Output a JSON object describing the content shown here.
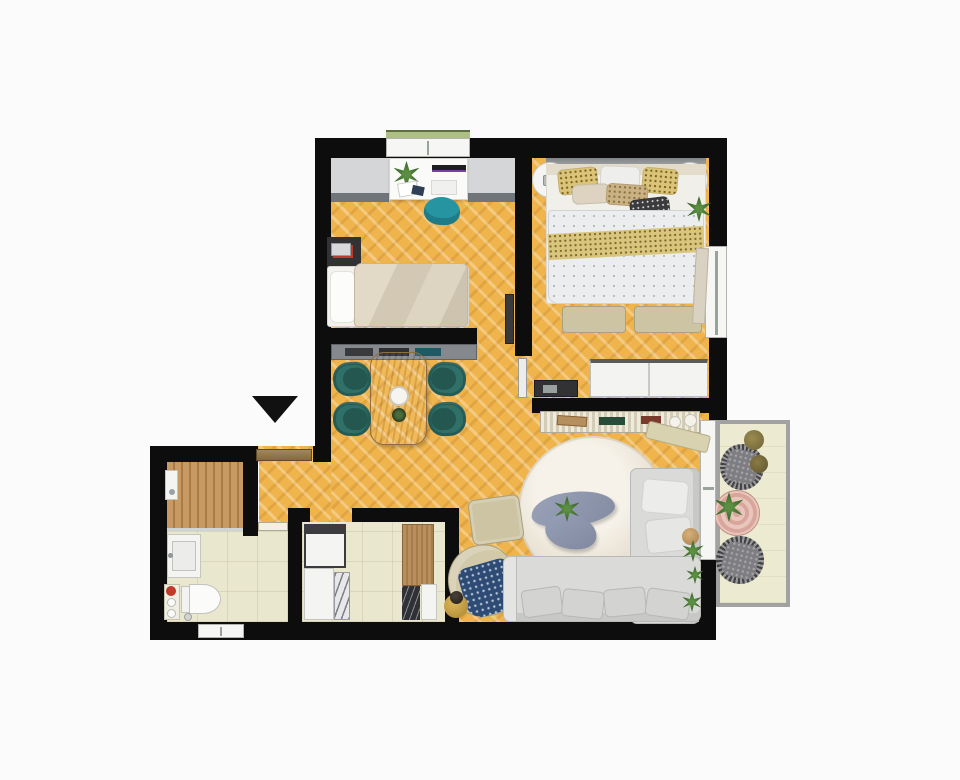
{
  "scene": {
    "kind": "apartment-floor-plan-3d-render",
    "view": "top-down",
    "canvas": {
      "width": 960,
      "height": 780
    },
    "text_visible": "none"
  },
  "colors": {
    "bg": "#fbfbfb",
    "wall": "#0d0d0d",
    "parquet": "#efb44c",
    "tile": "#e9e7cd",
    "wood-deck": "#c69a62",
    "wood-deck-dark": "#aa7b42",
    "balcony-floor": "#ecead0",
    "railing": "#a2a2a2",
    "teal-chair": "#2f7068",
    "teal-chair-dark": "#235750",
    "desk-chair-teal": "#2795a1",
    "sofa": "#dadad8",
    "beige-furniture": "#cdc4a3",
    "duvet": "#ecedee",
    "gold-band": "#d9c478",
    "wood-table": "#bb9264",
    "door-brown": "#92754a",
    "coffee-table": "#959db4",
    "throw-blue": "#2d4b74",
    "rug": "#f2ede3",
    "plant-green": "#2f5d23",
    "flower-red": "#c23a2c",
    "cushion-grey": "#7e7e82",
    "pouf-olive": "#857741",
    "counter-grey": "#d4d6d8",
    "counter-edge": "#70757a",
    "white-furniture": "#f4f4f2",
    "dark-furniture": "#323234",
    "slat-console": "#e6dfca"
  },
  "marker": {
    "entrance_arrow": {
      "shape": "triangle",
      "direction": "down",
      "color": "#111111"
    }
  },
  "rooms": [
    {
      "name": "office-bedroom",
      "floor": "parquet",
      "furniture": [
        "desk",
        "desk-cabinets",
        "desk-chair",
        "single-bed",
        "nightstand",
        "window"
      ]
    },
    {
      "name": "master-bedroom",
      "floor": "parquet",
      "furniture": [
        "double-bed",
        "round-nightstand-left",
        "round-nightstand-right",
        "foot-bench-left",
        "foot-bench-right",
        "wardrobe",
        "media-console",
        "plant",
        "window"
      ]
    },
    {
      "name": "dining-hall",
      "floor": "parquet",
      "furniture": [
        "dining-table",
        "dining-chairs-x4",
        "sideboard",
        "entry-door"
      ]
    },
    {
      "name": "living-room",
      "floor": "parquet",
      "furniture": [
        "corner-sofa",
        "round-rug",
        "coffee-table",
        "ottoman",
        "armchair",
        "side-table",
        "slat-console",
        "bench",
        "plants",
        "balcony-door"
      ]
    },
    {
      "name": "kitchen",
      "floor": "tile",
      "furniture": [
        "fridge",
        "base-cabinet",
        "marble-unit",
        "tall-wood-cabinet",
        "dark-marble-unit",
        "white-unit"
      ]
    },
    {
      "name": "bathroom",
      "floor": "tile",
      "furniture": [
        "shower-deck",
        "shower-fixture",
        "vanity-sink",
        "toilet",
        "shelf-with-flower",
        "floor-drain",
        "window"
      ]
    },
    {
      "name": "balcony",
      "floor": "tile-light",
      "furniture": [
        "wicker-chair-upper",
        "wicker-chair-lower",
        "striped-round-rug",
        "plant",
        "pouf-1",
        "pouf-2"
      ]
    }
  ]
}
